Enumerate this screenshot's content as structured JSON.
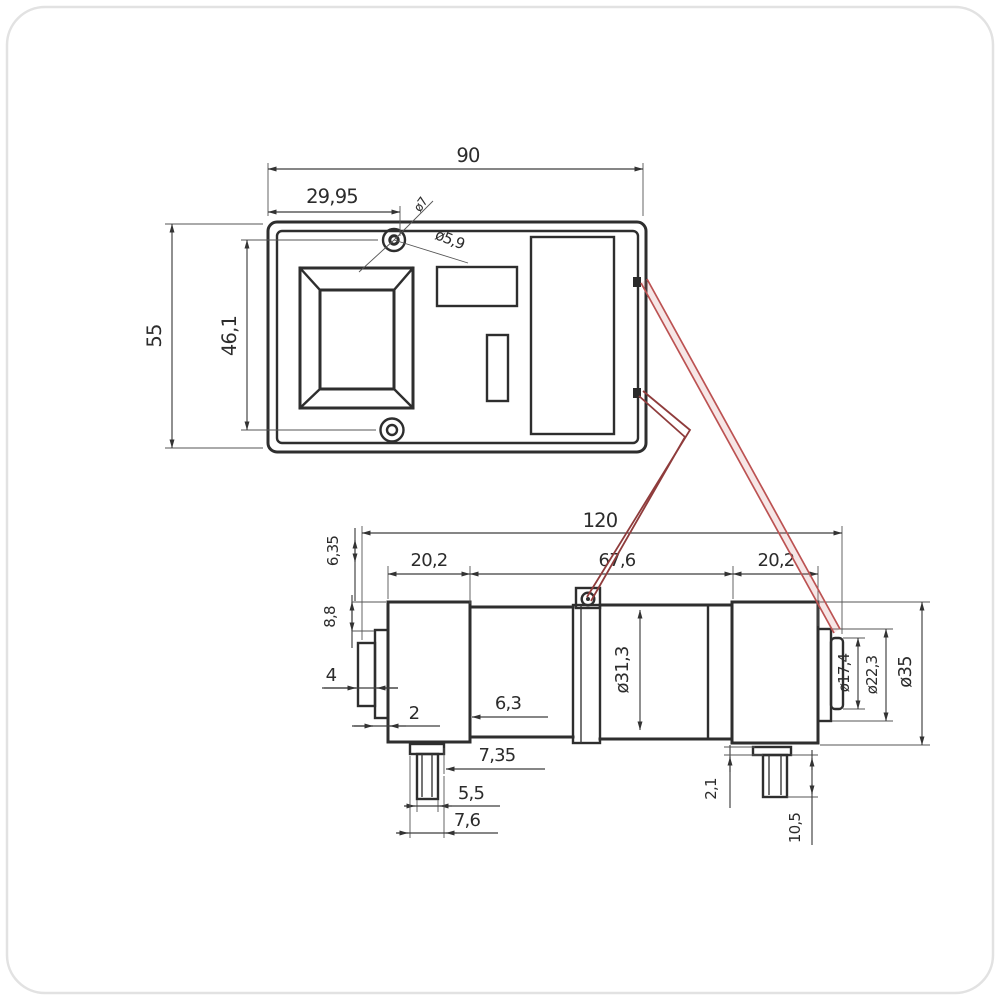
{
  "page": {
    "background": "#ffffff",
    "line_color": "#2e2e2e",
    "dim_color": "#3f3f3f",
    "highlight_color": "#bc5252"
  },
  "top_view": {
    "dims": {
      "width": "90",
      "hole_offset": "29,95",
      "height": "55",
      "screw_spacing": "46,1",
      "screw_dia": "ø7",
      "hole_dia": "ø5,9"
    }
  },
  "side_view": {
    "dims": {
      "length": "120",
      "left_section": "20,2",
      "middle_section": "67,6",
      "right_section": "20,2",
      "terminal_height": "6,35",
      "shoulder": "8,8",
      "step": "4",
      "edge": "2",
      "boss": "6,3",
      "pin_offset": "7,35",
      "pin_width": "5,5",
      "pin_flange": "7,6",
      "body_dia": "ø31,3",
      "tip_dia": "ø17,4",
      "collar_dia": "ø22,3",
      "cap_dia": "ø35",
      "flange_thickness": "2,1",
      "pin_length": "10,5"
    }
  }
}
